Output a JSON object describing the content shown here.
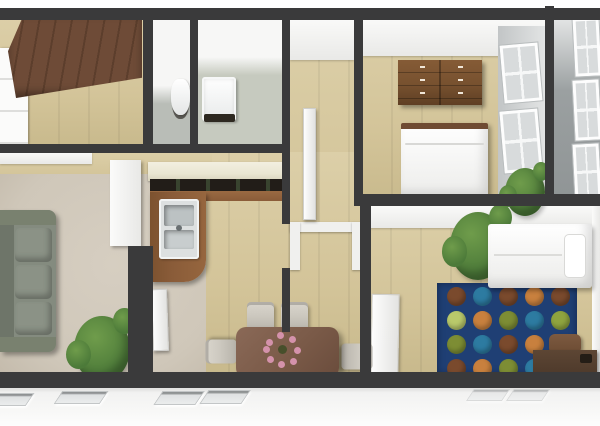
{
  "scene": {
    "title": "3D apartment floor plan render, top-down dollhouse view",
    "rooms": [
      {
        "id": "wardrobe-room",
        "position": "top-left",
        "floor": "wood"
      },
      {
        "id": "wc",
        "position": "top-middle-left",
        "floor": "gray tile"
      },
      {
        "id": "bathroom",
        "position": "top-middle",
        "floor": "gray-green tile"
      },
      {
        "id": "hallway",
        "position": "center",
        "floor": "wood"
      },
      {
        "id": "bedroom-top",
        "position": "top-right",
        "floor": "wood"
      },
      {
        "id": "balcony",
        "position": "right-edge",
        "floor": "gray"
      },
      {
        "id": "living-room",
        "position": "bottom-left",
        "floor": "beige carpet"
      },
      {
        "id": "kitchen",
        "position": "center-left",
        "floor": "wood"
      },
      {
        "id": "dining-area",
        "position": "bottom-center",
        "floor": "wood"
      },
      {
        "id": "bedroom-bottom",
        "position": "bottom-right",
        "floor": "wood"
      }
    ],
    "furniture": [
      "wardrobe",
      "white-closet",
      "toilet",
      "bathroom-sink",
      "hallway-door",
      "dresser",
      "double-bed",
      "window-pair",
      "balcony-windows",
      "sofa",
      "potted-plant-living",
      "kitchen-upper-cabinets",
      "kitchen-counter",
      "kitchen-sink",
      "tall-cabinet",
      "dining-table",
      "flower-centerpiece",
      "dining-chairs-x4",
      "potted-plant-bedroom",
      "single-bed",
      "polka-dot-rug",
      "desk",
      "desk-chair",
      "potted-plant-corner",
      "open-door-leaves"
    ]
  },
  "colors": {
    "page_bg": "#ffffff",
    "wall_dark": "#3a3a3b",
    "wood_floor": "#d3c499",
    "wood_light": "#dccfa8",
    "wood_dark": "#c8b98c",
    "carpet": "#cfc7b9",
    "gray_floor": "#b9bdb7",
    "graygreen_floor": "#c6cabf",
    "balcony_floor": "#9ba0a1",
    "facade": "#f2f2f1",
    "facade_window": "#dfe1e2",
    "window_glass": "#d8dbdc",
    "window_frame": "#fafbfb",
    "wardrobe_brown": "#6e4b37",
    "wardrobe_groove": "#5c3e2c",
    "dresser_brown": "#77512f",
    "counter_wood": "#8a5c39",
    "cabinet_cream": "#eae6d2",
    "counter_dark": "#221d18",
    "sink_silver": "#dde0e0",
    "sofa_green": "#848b7f",
    "sofa_dark": "#6e7569",
    "table_brown": "#7a5a48",
    "chair_gray": "#cdc9c0",
    "desk_brown": "#4e3a2b",
    "chair_brown": "#6b4b33",
    "bed_white": "#f4f4f3",
    "headboard_brown": "#6f4b33",
    "plant_green": "#4c7a39",
    "plant_light": "#6f9c4b",
    "rug_navy": "#1f3f74",
    "flower_pink": "#d492ab",
    "flower_center": "#474f2b"
  },
  "rug": {
    "dot_size": 19,
    "offset_x": 10,
    "offset_y": 4,
    "spacing_x": 26,
    "spacing_y": 24,
    "palette": {
      "B": "#7a4a2d",
      "T": "#2d7ba1",
      "O": "#c8803e",
      "G": "#7d8d34",
      "L": "#b9c96b",
      "N": "#8fa43f"
    },
    "rows": [
      [
        "B",
        "T",
        "B",
        "O",
        "B"
      ],
      [
        "L",
        "O",
        "G",
        "T",
        "N"
      ],
      [
        "G",
        "T",
        "B",
        "O",
        "L"
      ],
      [
        "B",
        "O",
        "G",
        "T",
        "O"
      ]
    ]
  }
}
